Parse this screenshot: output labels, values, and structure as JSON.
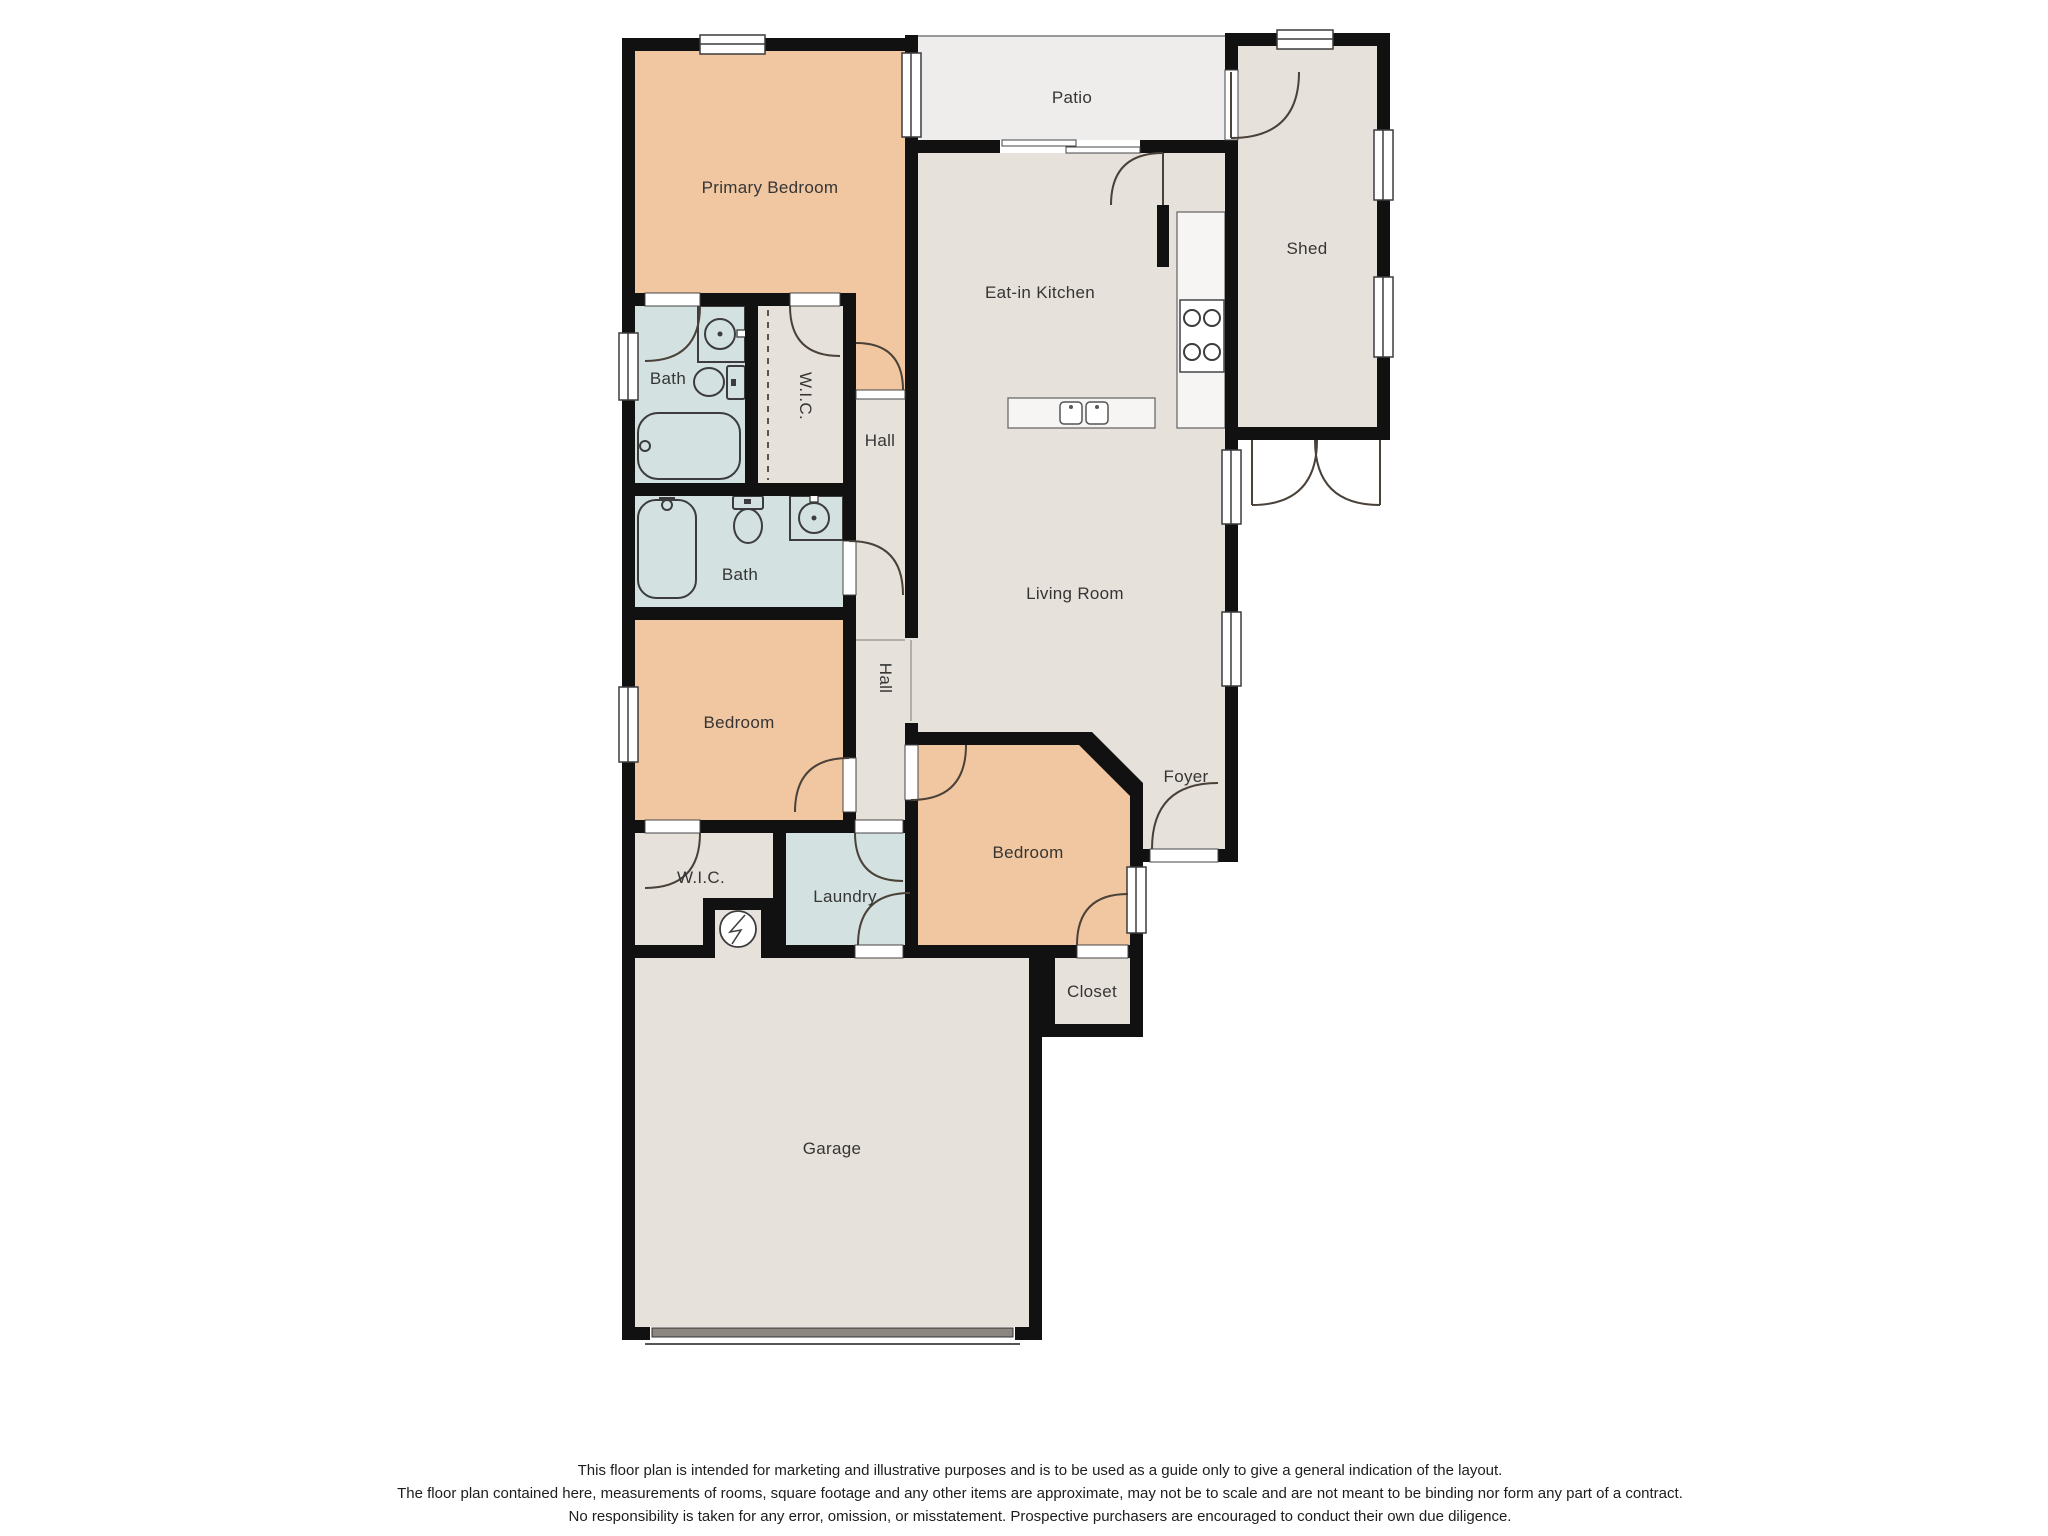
{
  "floor_plan": {
    "rooms": {
      "primary_bedroom": {
        "label": "Primary Bedroom"
      },
      "patio": {
        "label": "Patio"
      },
      "shed": {
        "label": "Shed"
      },
      "eat_in_kitchen": {
        "label": "Eat-in Kitchen"
      },
      "bath_primary": {
        "label": "Bath"
      },
      "wic_primary": {
        "label": "W.I.C."
      },
      "hall_upper": {
        "label": "Hall"
      },
      "bath_hall": {
        "label": "Bath"
      },
      "living_room": {
        "label": "Living Room"
      },
      "hall_lower": {
        "label": "Hall"
      },
      "bedroom_left": {
        "label": "Bedroom"
      },
      "bedroom_right": {
        "label": "Bedroom"
      },
      "foyer": {
        "label": "Foyer"
      },
      "wic_secondary": {
        "label": "W.I.C."
      },
      "laundry": {
        "label": "Laundry"
      },
      "closet": {
        "label": "Closet"
      },
      "garage": {
        "label": "Garage"
      }
    },
    "colors": {
      "wall": "#111111",
      "bedroom_fill": "#f1c7a1",
      "bath_fill": "#d3e2e0",
      "floor_fill": "#e7e1db",
      "patio_fill": "#eeedec"
    },
    "disclaimer": {
      "line1": "This floor plan is intended for marketing and illustrative purposes and is to be used as a guide only to give a general indication of the layout.",
      "line2": "The floor plan contained here, measurements of rooms, square footage and any other items are approximate, may not be to scale and are not meant to be binding nor form any part of a contract.",
      "line3": "No responsibility is taken for any error, omission, or misstatement. Prospective purchasers are encouraged to conduct their own due diligence."
    }
  }
}
